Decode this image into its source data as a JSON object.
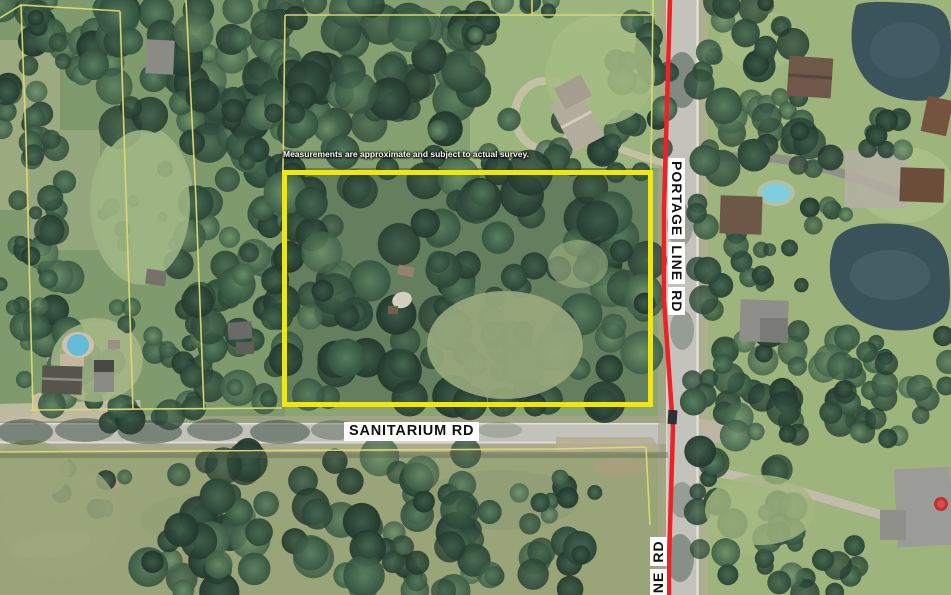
{
  "map": {
    "disclaimer": "Measurements are approximate and subject to actual survey.",
    "roads": {
      "sanitarium": {
        "label": "SANITARIUM RD"
      },
      "portage": {
        "label": "PORTAGE LINE RD"
      },
      "portage_south": {
        "label": "INE RD"
      }
    },
    "colors": {
      "highlight_yellow": "#f3e60a",
      "parcel_line_yellow": "#e0da74",
      "road_overlay_red": "#ee2126",
      "label_bg": "#ffffff",
      "label_text": "#111111",
      "disclaimer_text": "#ffffff"
    }
  }
}
